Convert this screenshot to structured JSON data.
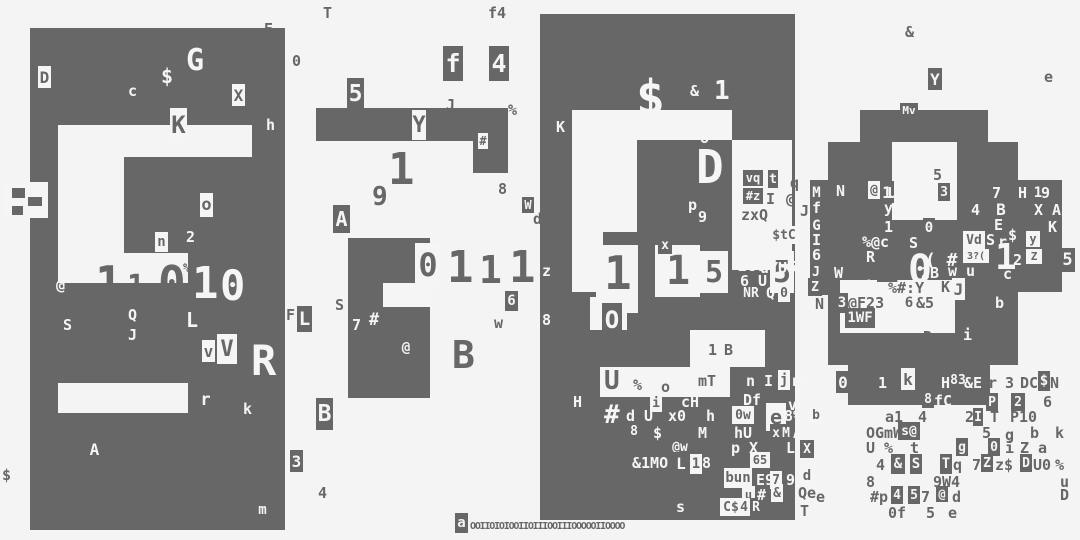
{
  "meta": {
    "bg": "#f4f4f4",
    "ink": "#676767",
    "paper": "#f5f5f5"
  },
  "blocks": [
    [
      30,
      28,
      255,
      97
    ],
    [
      30,
      125,
      28,
      405
    ],
    [
      252,
      125,
      33,
      128
    ],
    [
      124,
      157,
      128,
      96
    ],
    [
      30,
      283,
      255,
      100
    ],
    [
      188,
      253,
      97,
      30
    ],
    [
      30,
      413,
      255,
      117
    ],
    [
      188,
      383,
      97,
      30
    ],
    [
      316,
      108,
      192,
      33
    ],
    [
      473,
      141,
      35,
      32
    ],
    [
      348,
      238,
      82,
      160
    ],
    [
      540,
      14,
      255,
      506
    ],
    [
      860,
      110,
      128,
      32
    ],
    [
      828,
      142,
      190,
      128
    ],
    [
      828,
      270,
      190,
      95
    ],
    [
      848,
      365,
      142,
      40
    ],
    [
      1018,
      180,
      44,
      112
    ],
    [
      810,
      180,
      18,
      115
    ]
  ],
  "patches": [
    [
      383,
      283,
      47,
      24
    ],
    [
      572,
      110,
      160,
      30
    ],
    [
      572,
      140,
      65,
      92
    ],
    [
      732,
      140,
      60,
      130
    ],
    [
      572,
      230,
      31,
      62
    ],
    [
      690,
      330,
      75,
      37
    ],
    [
      600,
      367,
      130,
      30
    ],
    [
      596,
      245,
      42,
      68
    ],
    [
      655,
      245,
      45,
      52
    ],
    [
      590,
      297,
      37,
      33
    ],
    [
      892,
      142,
      65,
      78
    ],
    [
      840,
      280,
      115,
      53
    ],
    [
      3,
      182,
      45,
      36
    ]
  ],
  "mosaic": [
    [
      12,
      188,
      13,
      10
    ],
    [
      28,
      197,
      14,
      9
    ],
    [
      12,
      206,
      11,
      9
    ]
  ],
  "digits": [
    [
      "1",
      95,
      260,
      46,
      "i"
    ],
    [
      "1",
      127,
      272,
      30,
      "i"
    ],
    [
      "0",
      158,
      260,
      46,
      "i"
    ],
    [
      "1",
      192,
      262,
      44,
      "p"
    ],
    [
      "0",
      220,
      265,
      42,
      "p"
    ],
    [
      "1",
      250,
      263,
      40,
      "i"
    ],
    [
      "1",
      352,
      246,
      46,
      "i"
    ],
    [
      "1",
      385,
      250,
      36,
      "i"
    ],
    [
      "1",
      447,
      246,
      44,
      "i"
    ],
    [
      "1",
      479,
      251,
      38,
      "i"
    ],
    [
      "1",
      509,
      246,
      44,
      "i"
    ],
    [
      "1",
      604,
      250,
      46,
      "i"
    ],
    [
      "1",
      666,
      251,
      40,
      "i"
    ],
    [
      "1",
      873,
      246,
      44,
      "i"
    ],
    [
      "0",
      908,
      250,
      40,
      "p"
    ],
    [
      "1",
      995,
      240,
      36,
      "p"
    ]
  ],
  "tiles": [
    [
      "D",
      38,
      66,
      13,
      22,
      1
    ],
    [
      "X",
      232,
      84,
      13,
      22,
      1
    ],
    [
      "K",
      170,
      108,
      17,
      34,
      1
    ],
    [
      "o",
      200,
      193,
      13,
      24,
      1
    ],
    [
      "n",
      155,
      232,
      13,
      20,
      1
    ],
    [
      "v",
      202,
      340,
      13,
      22,
      1
    ],
    [
      "V",
      217,
      334,
      20,
      30,
      1
    ],
    [
      "L",
      297,
      306,
      15,
      26,
      0
    ],
    [
      "r",
      199,
      388,
      13,
      24,
      0
    ],
    [
      "A",
      88,
      438,
      13,
      22,
      0
    ],
    [
      "3",
      290,
      450,
      13,
      22,
      0
    ],
    [
      "m",
      256,
      500,
      13,
      20,
      0
    ],
    [
      "B",
      316,
      398,
      17,
      32,
      0
    ],
    [
      "5",
      347,
      78,
      17,
      32,
      0
    ],
    [
      "Y",
      412,
      110,
      14,
      30,
      1
    ],
    [
      "#",
      478,
      133,
      10,
      16,
      1
    ],
    [
      "A",
      333,
      205,
      17,
      28,
      0
    ],
    [
      "#",
      366,
      308,
      16,
      24,
      0
    ],
    [
      "@",
      398,
      338,
      16,
      20,
      0
    ],
    [
      "6",
      505,
      291,
      13,
      20,
      0
    ],
    [
      "W",
      522,
      197,
      12,
      16,
      0
    ],
    [
      "f",
      443,
      46,
      20,
      35,
      0
    ],
    [
      "4",
      489,
      46,
      20,
      35,
      0
    ],
    [
      "0",
      415,
      243,
      26,
      44,
      1
    ],
    [
      "x",
      658,
      236,
      14,
      18,
      0
    ],
    [
      "O",
      602,
      303,
      20,
      34,
      0
    ],
    [
      "5",
      700,
      251,
      28,
      42,
      1
    ],
    [
      "5",
      770,
      251,
      24,
      42,
      1
    ],
    [
      "vq",
      743,
      170,
      20,
      16,
      0
    ],
    [
      "t",
      768,
      170,
      10,
      18,
      0
    ],
    [
      "#z",
      743,
      188,
      20,
      16,
      0
    ],
    [
      "$tC",
      770,
      226,
      28,
      18,
      1
    ],
    [
      "NR",
      740,
      284,
      22,
      18,
      0
    ],
    [
      "0",
      778,
      284,
      12,
      18,
      1
    ],
    [
      "j",
      778,
      370,
      12,
      20,
      1
    ],
    [
      "i",
      650,
      394,
      12,
      18,
      1
    ],
    [
      "0w",
      732,
      406,
      22,
      18,
      1
    ],
    [
      "e",
      766,
      403,
      20,
      28,
      1
    ],
    [
      "b",
      810,
      406,
      12,
      18,
      1
    ],
    [
      "8",
      628,
      422,
      12,
      18,
      0
    ],
    [
      "x",
      770,
      424,
      12,
      18,
      0
    ],
    [
      "M",
      780,
      424,
      12,
      18,
      0
    ],
    [
      "@w",
      668,
      438,
      24,
      18,
      0
    ],
    [
      "X",
      800,
      440,
      14,
      18,
      0
    ],
    [
      "L",
      674,
      452,
      14,
      22,
      0
    ],
    [
      "1",
      690,
      454,
      12,
      20,
      1
    ],
    [
      "65",
      750,
      452,
      20,
      16,
      1
    ],
    [
      "bun",
      724,
      468,
      28,
      20,
      1
    ],
    [
      "7",
      770,
      471,
      12,
      18,
      1
    ],
    [
      "d",
      800,
      466,
      14,
      20,
      1
    ],
    [
      "u",
      742,
      486,
      13,
      17,
      1
    ],
    [
      "&",
      771,
      484,
      12,
      18,
      1
    ],
    [
      "C$",
      720,
      498,
      22,
      18,
      1
    ],
    [
      "4",
      738,
      498,
      12,
      18,
      1
    ],
    [
      "R",
      750,
      498,
      12,
      18,
      0
    ],
    [
      "a",
      455,
      513,
      13,
      20,
      0
    ],
    [
      "Mv",
      900,
      103,
      18,
      15,
      0
    ],
    [
      "Y",
      928,
      68,
      14,
      22,
      0
    ],
    [
      "M",
      810,
      183,
      13,
      20,
      0
    ],
    [
      "@",
      868,
      181,
      12,
      18,
      1
    ],
    [
      "1",
      880,
      181,
      14,
      22,
      0
    ],
    [
      "3",
      938,
      183,
      12,
      18,
      0
    ],
    [
      "1",
      1032,
      183,
      12,
      20,
      0
    ],
    [
      "B",
      994,
      198,
      14,
      22,
      0
    ],
    [
      "G",
      810,
      216,
      13,
      20,
      0
    ],
    [
      "0",
      923,
      218,
      12,
      20,
      0
    ],
    [
      "Vd",
      963,
      231,
      22,
      18,
      1
    ],
    [
      "3?(",
      963,
      249,
      26,
      14,
      1
    ],
    [
      "y",
      1026,
      231,
      14,
      16,
      1
    ],
    [
      "Z",
      1026,
      249,
      16,
      15,
      1
    ],
    [
      "5",
      1060,
      248,
      15,
      24,
      0
    ],
    [
      "J",
      810,
      263,
      12,
      18,
      0
    ],
    [
      "Z",
      808,
      278,
      14,
      18,
      0
    ],
    [
      "J",
      952,
      278,
      13,
      22,
      1
    ],
    [
      "3",
      836,
      293,
      12,
      20,
      0
    ],
    [
      "6",
      903,
      293,
      12,
      20,
      1
    ],
    [
      "1WF",
      845,
      308,
      30,
      20,
      0
    ],
    [
      "0",
      836,
      371,
      14,
      22,
      0
    ],
    [
      "k",
      901,
      368,
      14,
      22,
      1
    ],
    [
      "83",
      948,
      371,
      20,
      18,
      0
    ],
    [
      "$",
      1038,
      371,
      12,
      20,
      0
    ],
    [
      "8",
      922,
      390,
      12,
      18,
      0
    ],
    [
      "P",
      986,
      393,
      12,
      18,
      0
    ],
    [
      "2",
      1011,
      393,
      14,
      18,
      0
    ],
    [
      "I",
      973,
      408,
      10,
      18,
      0
    ],
    [
      "s@",
      898,
      422,
      22,
      18,
      0
    ],
    [
      "g",
      956,
      438,
      12,
      18,
      0
    ],
    [
      "0",
      988,
      438,
      12,
      18,
      0
    ],
    [
      "&",
      891,
      454,
      14,
      20,
      0
    ],
    [
      "S",
      910,
      454,
      12,
      20,
      0
    ],
    [
      "T",
      940,
      454,
      12,
      20,
      0
    ],
    [
      "Z",
      981,
      454,
      12,
      18,
      0
    ],
    [
      "D",
      1020,
      454,
      12,
      18,
      0
    ],
    [
      "4",
      891,
      486,
      12,
      18,
      0
    ],
    [
      "5",
      908,
      486,
      12,
      18,
      0
    ],
    [
      "@",
      936,
      486,
      12,
      16,
      0
    ]
  ],
  "chars_ink": [
    [
      "T",
      323,
      6
    ],
    [
      "f4",
      488,
      6
    ],
    [
      "E",
      264,
      22
    ],
    [
      "0",
      292,
      54
    ],
    [
      "&",
      905,
      25
    ],
    [
      "e",
      1044,
      70
    ],
    [
      "J",
      446,
      98
    ],
    [
      "%",
      508,
      103
    ],
    [
      "8",
      498,
      182
    ],
    [
      "d",
      533,
      212
    ],
    [
      "%",
      183,
      262,
      12
    ],
    [
      "S",
      335,
      298
    ],
    [
      "F",
      286,
      308
    ],
    [
      "w",
      494,
      316
    ],
    [
      "t",
      36,
      374
    ],
    [
      "q",
      42,
      406
    ],
    [
      "$",
      2,
      468
    ],
    [
      "4",
      318,
      486
    ],
    [
      "B",
      452,
      336,
      38
    ],
    [
      "1",
      388,
      148,
      44
    ],
    [
      "9",
      372,
      184,
      26
    ],
    [
      "5",
      933,
      168
    ],
    [
      "q",
      790,
      176
    ],
    [
      "I",
      766,
      192
    ],
    [
      "@",
      786,
      192
    ],
    [
      "r z",
      723,
      208
    ],
    [
      "xQ",
      750,
      208
    ],
    [
      "J",
      800,
      204
    ],
    [
      "U",
      604,
      368,
      26
    ],
    [
      "%",
      633,
      378
    ],
    [
      "o",
      661,
      380
    ],
    [
      "mT",
      698,
      374
    ],
    [
      "1",
      708,
      343
    ],
    [
      "B",
      724,
      343
    ],
    [
      "Qe",
      798,
      486
    ],
    [
      "T",
      800,
      504
    ],
    [
      "N",
      815,
      297
    ],
    [
      "@F23",
      848,
      296
    ],
    [
      "&5",
      916,
      296
    ],
    [
      "R",
      923,
      330
    ],
    [
      "K",
      941,
      280
    ],
    [
      "%#:Y",
      888,
      281
    ],
    [
      "a1",
      885,
      410
    ],
    [
      "4",
      918,
      410
    ],
    [
      "2",
      965,
      410
    ],
    [
      "T",
      990,
      410
    ],
    [
      "P10",
      1010,
      410
    ],
    [
      "OGmW",
      866,
      426
    ],
    [
      "5",
      982,
      426
    ],
    [
      "g",
      1005,
      428
    ],
    [
      "b",
      1030,
      426
    ],
    [
      "k",
      1055,
      426
    ],
    [
      "U %",
      866,
      441
    ],
    [
      "t",
      910,
      441
    ],
    [
      "i",
      1005,
      441
    ],
    [
      "Z",
      1020,
      441
    ],
    [
      "a",
      1038,
      441
    ],
    [
      "4",
      876,
      458
    ],
    [
      "q",
      953,
      458
    ],
    [
      "7",
      972,
      458
    ],
    [
      "z$",
      995,
      458
    ],
    [
      "U0",
      1033,
      458
    ],
    [
      "%",
      1055,
      458
    ],
    [
      "8",
      866,
      475
    ],
    [
      "9W4",
      933,
      475
    ],
    [
      "u",
      1060,
      475
    ],
    [
      "#p",
      870,
      490
    ],
    [
      "7",
      921,
      490
    ],
    [
      "d",
      952,
      490
    ],
    [
      "D",
      1060,
      488
    ],
    [
      "e",
      816,
      490
    ],
    [
      "0f",
      888,
      506
    ],
    [
      "5",
      926,
      506
    ],
    [
      "e",
      948,
      506
    ],
    [
      "r",
      988,
      376
    ],
    [
      "3",
      1005,
      376
    ],
    [
      "DC",
      1020,
      376
    ],
    [
      "N",
      1050,
      376
    ],
    [
      "6",
      1043,
      395
    ]
  ],
  "chars_paper": [
    [
      "G",
      186,
      46,
      30
    ],
    [
      "$",
      161,
      66,
      20
    ],
    [
      "c",
      128,
      84
    ],
    [
      "h",
      266,
      118
    ],
    [
      "2",
      186,
      230
    ],
    [
      "@",
      56,
      278
    ],
    [
      "Q",
      128,
      308
    ],
    [
      "J",
      128,
      328
    ],
    [
      "S",
      63,
      318
    ],
    [
      "L",
      186,
      310,
      20
    ],
    [
      "R",
      251,
      340,
      42
    ],
    [
      "k",
      243,
      402
    ],
    [
      "7",
      352,
      318
    ],
    [
      "K",
      556,
      120
    ],
    [
      "$",
      636,
      74,
      48
    ],
    [
      "&",
      690,
      84
    ],
    [
      "1",
      714,
      78,
      26
    ],
    [
      "o",
      700,
      131
    ],
    [
      "D",
      696,
      144,
      46
    ],
    [
      "p",
      688,
      198
    ],
    [
      "9",
      698,
      210
    ],
    [
      "z",
      542,
      264
    ],
    [
      "8",
      542,
      313
    ],
    [
      "NoU",
      734,
      227
    ],
    [
      "F",
      736,
      246
    ],
    [
      "S",
      757,
      246
    ],
    [
      "s",
      796,
      249
    ],
    [
      "2G.",
      738,
      259
    ],
    [
      "uYU",
      760,
      261
    ],
    [
      "6 U",
      740,
      274
    ],
    [
      "5",
      788,
      260
    ],
    [
      "Q",
      766,
      286
    ],
    [
      "3",
      795,
      288
    ],
    [
      "H",
      573,
      395
    ],
    [
      "cH",
      681,
      395
    ],
    [
      "Df",
      743,
      393
    ],
    [
      "va",
      788,
      398
    ],
    [
      "n",
      746,
      374
    ],
    [
      "I",
      764,
      374
    ],
    [
      "rd",
      791,
      374
    ],
    [
      "#",
      604,
      402,
      26
    ],
    [
      "d U",
      626,
      409
    ],
    [
      "x0",
      668,
      409
    ],
    [
      "h",
      706,
      409
    ],
    [
      "8%O",
      784,
      409
    ],
    [
      "M",
      698,
      426
    ],
    [
      "$",
      653,
      426
    ],
    [
      "hU",
      734,
      426
    ],
    [
      "Au6",
      793,
      426
    ],
    [
      "p X",
      731,
      441
    ],
    [
      "L",
      786,
      441
    ],
    [
      "&1MO",
      632,
      456
    ],
    [
      "8",
      702,
      456
    ],
    [
      "E9",
      756,
      473
    ],
    [
      "9",
      786,
      473
    ],
    [
      "#",
      757,
      488
    ],
    [
      "s",
      676,
      500
    ],
    [
      "w u",
      948,
      264
    ],
    [
      "c",
      1003,
      267
    ],
    [
      "2B",
      921,
      266
    ],
    [
      "W",
      834,
      266
    ],
    [
      "i",
      864,
      280
    ],
    [
      "b",
      995,
      296
    ],
    [
      "i",
      963,
      328
    ],
    [
      "A",
      896,
      311
    ],
    [
      "N",
      836,
      184
    ],
    [
      "UF",
      888,
      186
    ],
    [
      "8",
      914,
      186
    ],
    [
      "o",
      928,
      186
    ],
    [
      "7",
      992,
      186
    ],
    [
      "H",
      1018,
      186
    ],
    [
      "9",
      1041,
      186
    ],
    [
      "f",
      812,
      201
    ],
    [
      "y",
      884,
      201
    ],
    [
      "K5",
      906,
      201
    ],
    [
      "4",
      971,
      203
    ],
    [
      "X A",
      1034,
      203
    ],
    [
      "1",
      884,
      220
    ],
    [
      "E",
      994,
      218
    ],
    [
      "K",
      1048,
      220
    ],
    [
      "I",
      812,
      233
    ],
    [
      "%@c",
      862,
      235
    ],
    [
      "S",
      909,
      236
    ],
    [
      "S",
      986,
      233
    ],
    [
      "r",
      998,
      235
    ],
    [
      "$",
      1008,
      228
    ],
    [
      "( #",
      925,
      252,
      18
    ],
    [
      "2",
      1013,
      253
    ],
    [
      "6",
      812,
      248
    ],
    [
      "R",
      866,
      250
    ],
    [
      "fC",
      934,
      394
    ],
    [
      "&E",
      964,
      376
    ],
    [
      "H",
      941,
      376
    ],
    [
      "1",
      878,
      376
    ]
  ],
  "strip": {
    "text": "OOIIOIOIOOIIOIIIOOIIIOOOOOIIOOOO",
    "x": 470,
    "y": 522,
    "size": 10,
    "spacing": -1.2
  }
}
